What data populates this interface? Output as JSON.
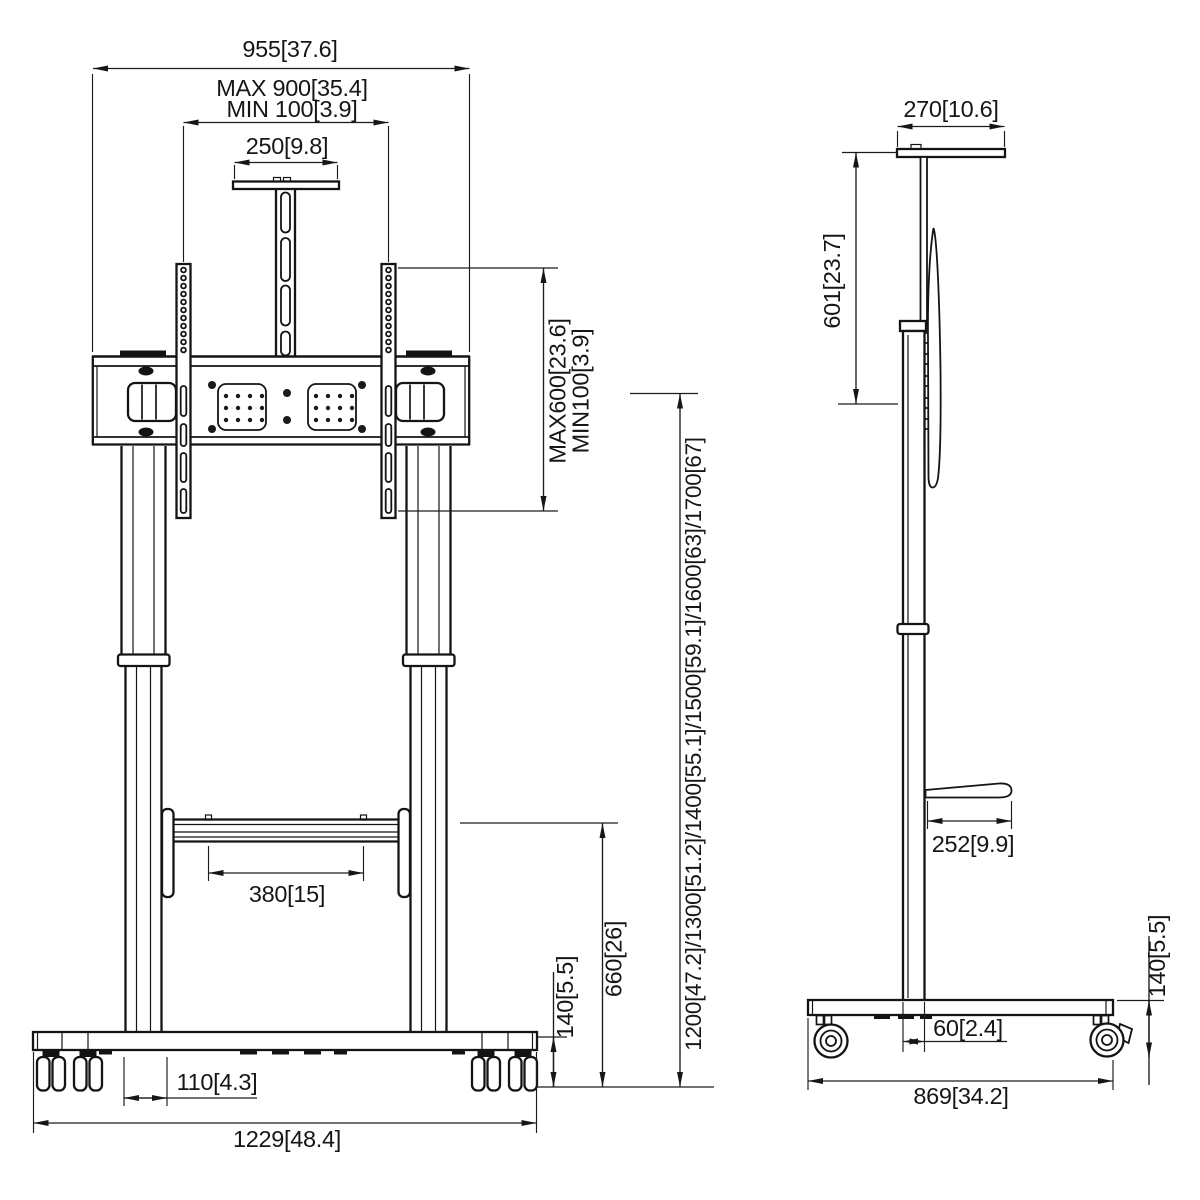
{
  "dims": {
    "front": {
      "overall_width": "955[37.6]",
      "vesa_width_max": "MAX 900[35.4]",
      "vesa_width_min": "MIN 100[3.9]",
      "camera_shelf_width": "250[9.8]",
      "vesa_height_max": "MAX600[23.6]",
      "vesa_height_min": "MIN100[3.9]",
      "column_height_options": "1200[47.2]/1300[51.2]/1400[55.1]/1500[59.1]/1600[63]/1700[67]",
      "shelf_clear_width": "380[15]",
      "shelf_floor_height": "660[26]",
      "base_height": "140[5.5]",
      "leg_inset": "110[4.3]",
      "base_width": "1229[48.4]"
    },
    "side": {
      "top_shelf_depth": "270[10.6]",
      "drop_height": "601[23.7]",
      "shelf_depth": "252[9.9]",
      "column_offset": "60[2.4]",
      "base_depth": "869[34.2]",
      "base_height": "140[5.5]"
    }
  }
}
